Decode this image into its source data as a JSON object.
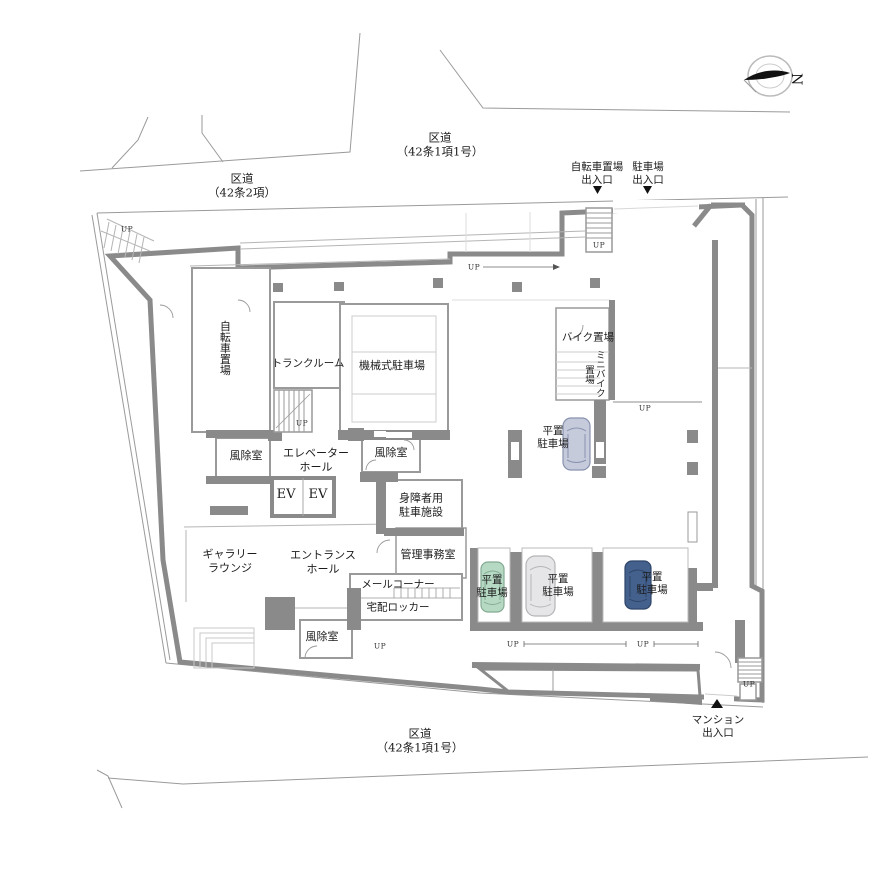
{
  "roads": {
    "top": "区道\n（42条1項1号）",
    "top_left": "区道\n（42条2項）",
    "bottom": "区道\n（42条1項1号）"
  },
  "entrances": {
    "bicycle": "自転車置場\n出入口",
    "parking": "駐車場\n出入口",
    "mansion": "マンション\n出入口"
  },
  "rooms": {
    "bicycle_storage": "自転車置場",
    "trunk_room": "トランクルーム",
    "mechanical_parking": "機械式駐車場",
    "bike_storage": "バイク置場",
    "minibike_storage": "ミニバイク置場",
    "flat_parking": "平置\n駐車場",
    "windbreak_room": "風除室",
    "elevator_hall": "エレベーター\nホール",
    "elevators": "EV　EV",
    "disabled_parking": "身障者用\n駐車施設",
    "gallery_lounge": "ギャラリー\nラウンジ",
    "entrance_hall": "エントランス\nホール",
    "management_office": "管理事務室",
    "mail_corner": "メールコーナー",
    "delivery_locker": "宅配ロッカー"
  },
  "marks": {
    "up": "UP",
    "north": "N"
  },
  "colors": {
    "wall": "#8a8a8a",
    "boundary": "#9a9a9a",
    "car_upper": "#c6cbdb",
    "car_green": "#b5d9c3",
    "car_white": "#e6e6e8",
    "car_navy": "#44618e"
  }
}
